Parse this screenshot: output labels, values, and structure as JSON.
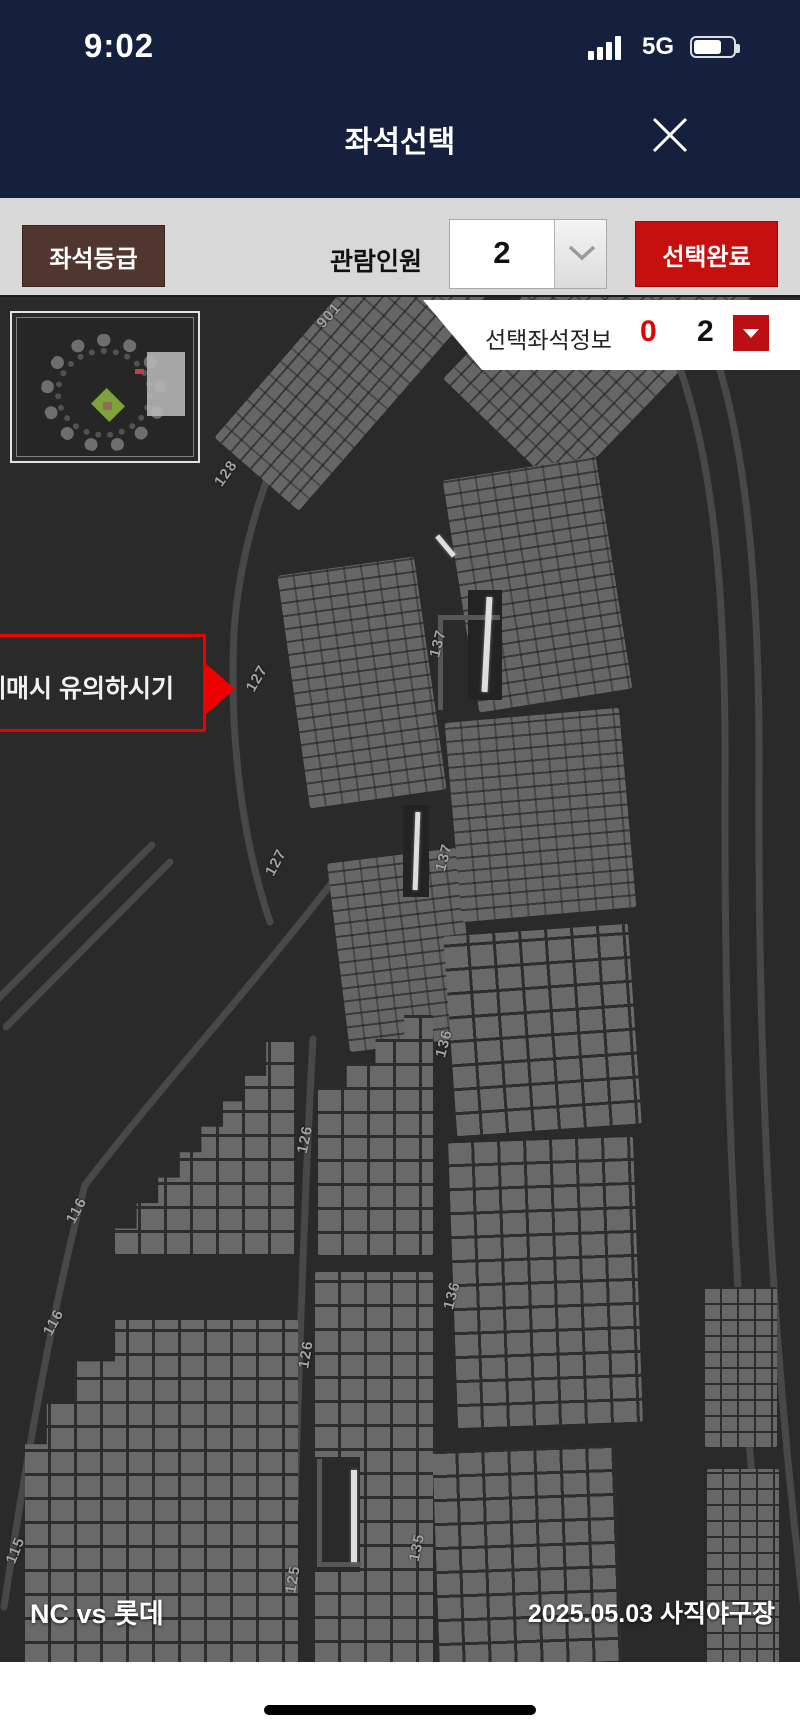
{
  "status_bar": {
    "time": "9:02",
    "network": "5G"
  },
  "header": {
    "title": "좌석선택"
  },
  "toolbar": {
    "seat_grade_label": "좌석등급",
    "viewer_count_label": "관람인원",
    "viewer_count_value": "2",
    "complete_label": "선택완료"
  },
  "seat_info_bar": {
    "label": "선택좌석정보",
    "selected_count": "0",
    "total_count": "2"
  },
  "notice_callout": {
    "text": "예매시 유의하시기"
  },
  "map": {
    "section_labels": [
      {
        "text": "901"
      },
      {
        "text": "128"
      },
      {
        "text": "127"
      },
      {
        "text": "127"
      },
      {
        "text": "137"
      },
      {
        "text": "137"
      },
      {
        "text": "136"
      },
      {
        "text": "136"
      },
      {
        "text": "135"
      },
      {
        "text": "126"
      },
      {
        "text": "126"
      },
      {
        "text": "125"
      },
      {
        "text": "116"
      },
      {
        "text": "116"
      },
      {
        "text": "115"
      }
    ]
  },
  "footer": {
    "match": "NC vs 롯데",
    "date_venue": "2025.05.03 사직야구장"
  },
  "colors": {
    "navy": "#14203e",
    "accent_red": "#c60f0f",
    "brown": "#50362e",
    "info_red": "#e60000"
  }
}
